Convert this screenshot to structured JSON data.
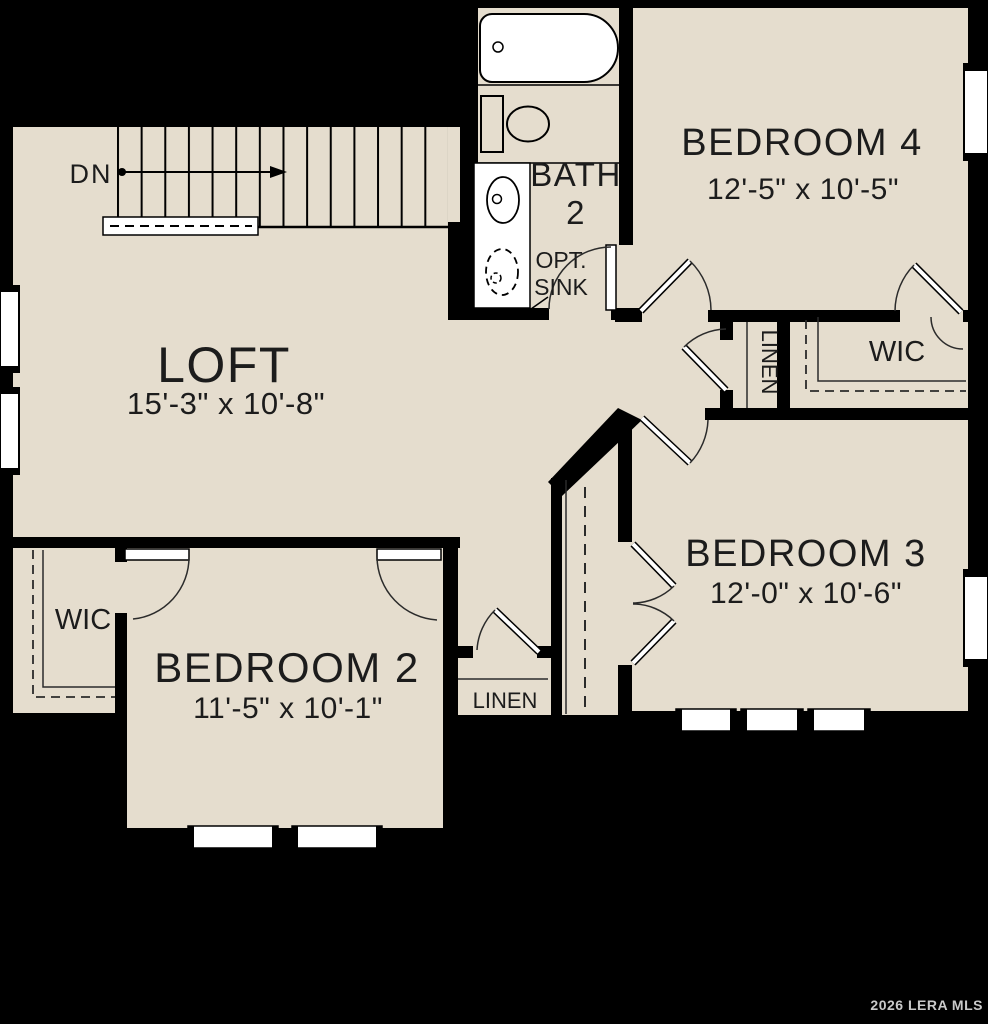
{
  "watermark": "2026 LERA MLS",
  "colors": {
    "floor": "#e5ddce",
    "wall": "#000000",
    "fixture": "#ffffff",
    "line": "#2b2b2b",
    "label": "#1c1c1c",
    "watermark": "#c9c9c9"
  },
  "stairs": {
    "label": "DN"
  },
  "rooms": {
    "loft": {
      "name": "LOFT",
      "dims": "15'-3\" x 10'-8\""
    },
    "bedroom4": {
      "name": "BEDROOM 4",
      "dims": "12'-5\" x 10'-5\""
    },
    "bedroom3": {
      "name": "BEDROOM 3",
      "dims": "12'-0\" x 10'-6\""
    },
    "bedroom2": {
      "name": "BEDROOM 2",
      "dims": "11'-5\" x 10'-1\""
    },
    "bath2": {
      "name": "BATH",
      "number": "2",
      "option_line1": "OPT.",
      "option_line2": "SINK"
    },
    "wic_right": {
      "name": "WIC"
    },
    "wic_left": {
      "name": "WIC"
    },
    "linen_hall": {
      "name": "LINEN"
    },
    "linen_lower": {
      "name": "LINEN"
    }
  }
}
